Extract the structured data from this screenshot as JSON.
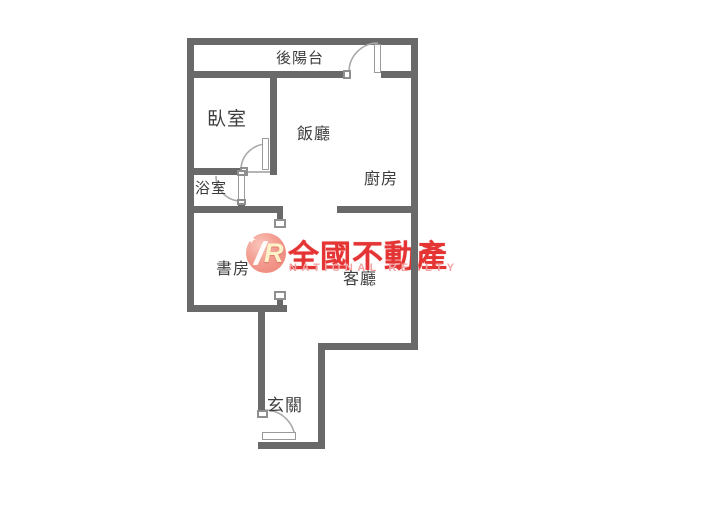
{
  "page": {
    "title": "floor-plan"
  },
  "rooms": {
    "balcony": {
      "label": "後陽台"
    },
    "bedroom": {
      "label": "臥室"
    },
    "dining": {
      "label": "飯廳"
    },
    "kitchen": {
      "label": "廚房"
    },
    "bathroom": {
      "label": "浴室"
    },
    "study": {
      "label": "書房"
    },
    "living": {
      "label": "客廳"
    },
    "entrance": {
      "label": "玄關"
    }
  },
  "watermark": {
    "logo_letter": "R",
    "brand": "全國不動產",
    "subtitle": "NATIONAL REALTY",
    "colors": {
      "brand_red": "#e43434",
      "subtitle_pink": "#f2a2a2",
      "logo_circle": "#ee857c"
    }
  },
  "colors": {
    "wall_gray": "#696969",
    "label_text": "#3d3d3d",
    "background": "#ffffff"
  }
}
